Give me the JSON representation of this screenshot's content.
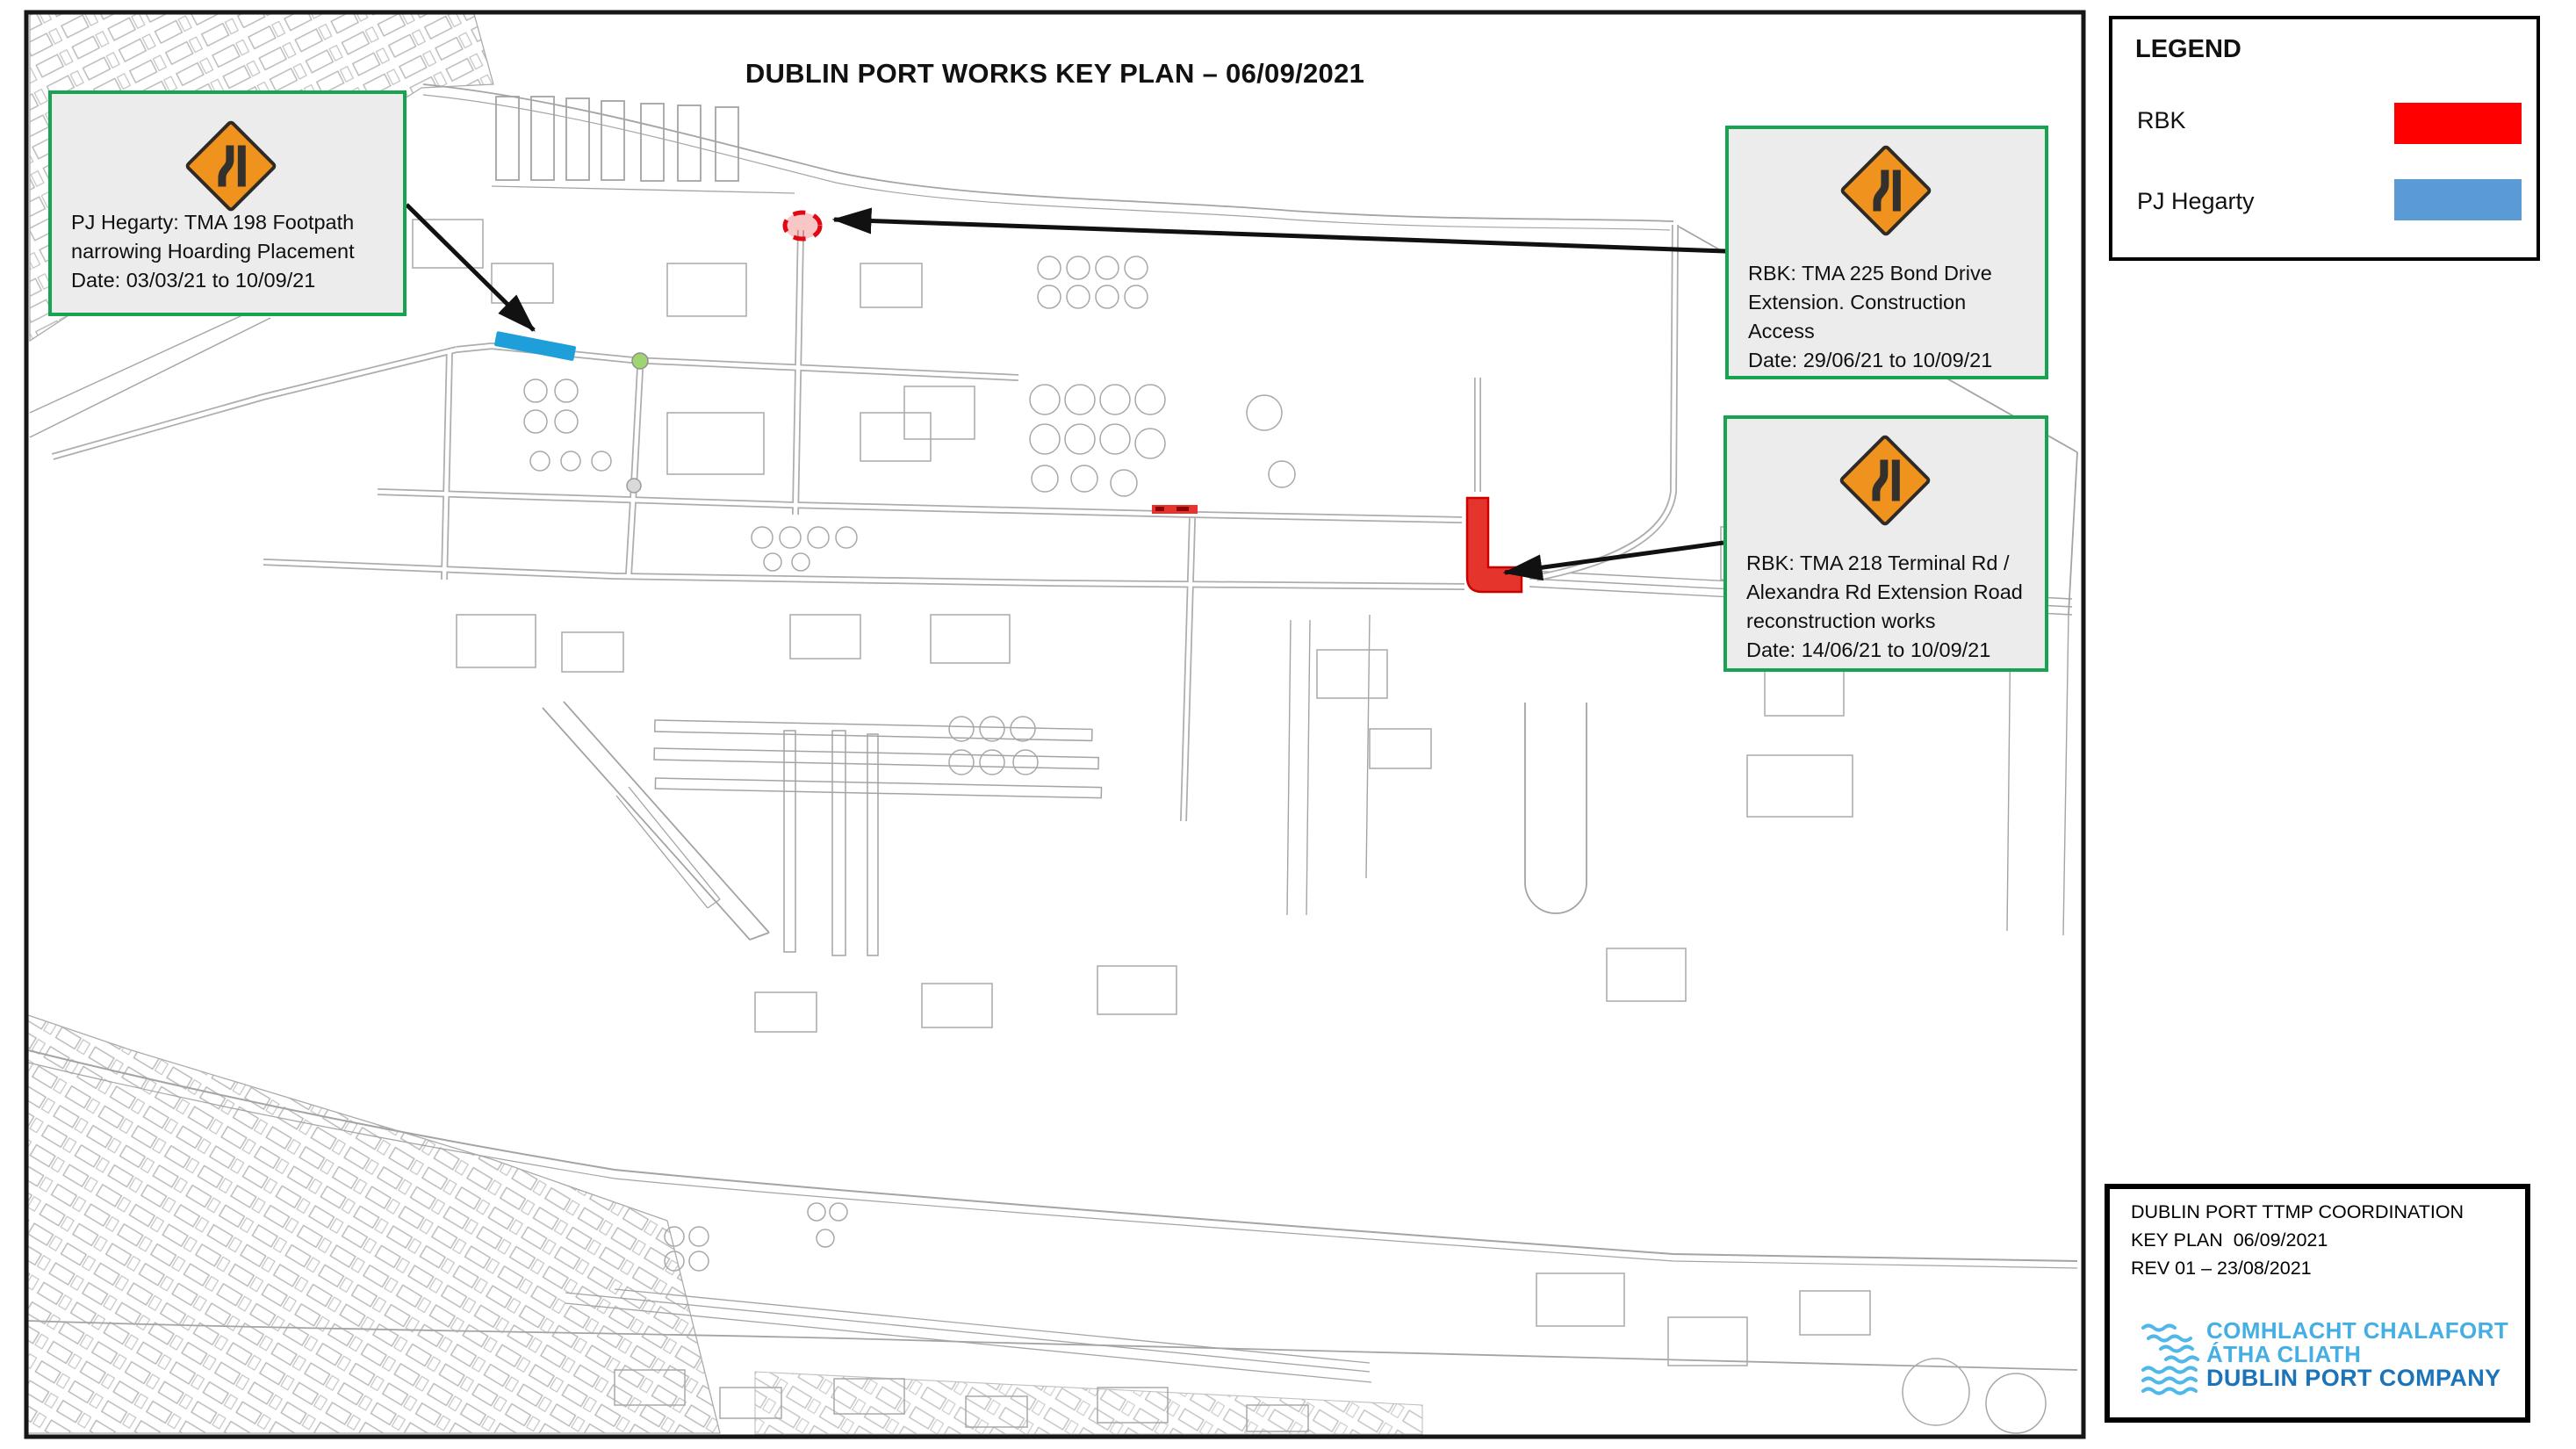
{
  "title": "DUBLIN PORT WORKS KEY PLAN – 06/09/2021",
  "callouts": [
    {
      "id": "tma-198",
      "text": "PJ Hegarty: TMA 198 Footpath\nnarrowing Hoarding Placement\nDate: 03/03/21 to 10/09/21"
    },
    {
      "id": "tma-225",
      "text": "RBK: TMA 225 Bond Drive\nExtension. Construction\nAccess\nDate: 29/06/21 to 10/09/21"
    },
    {
      "id": "tma-218",
      "text": "RBK: TMA 218 Terminal Rd /\nAlexandra Rd Extension Road\nreconstruction works\nDate: 14/06/21 to 10/09/21"
    }
  ],
  "legend": {
    "title": "LEGEND",
    "entries": [
      {
        "label": "RBK",
        "color": "#FE0000"
      },
      {
        "label": "PJ Hegarty",
        "color": "#5B9BD5"
      }
    ]
  },
  "title_block": {
    "line1": "DUBLIN PORT TTMP COORDINATION",
    "line2": "KEY PLAN  06/09/2021",
    "line3": "REV 01 – 23/08/2021",
    "logo": {
      "line1": "COMHLACHT CHALAFORT",
      "line2": "ÁTHA CLIATH",
      "line3": "DUBLIN PORT COMPANY",
      "light_blue": "#45AEE3",
      "dark_blue": "#1B74B9"
    }
  },
  "markers": {
    "pj_hegarty_footpath_zone": {
      "color": "#1E9FD9"
    },
    "bond_drive_extension_zone": {
      "color": "#E30613"
    },
    "terminal_rd_works_zone": {
      "color": "#E5342C"
    },
    "tolka_quay_rd_segment": {
      "color": "#E5342C"
    }
  },
  "sign": {
    "meaning": "road-narrows-warning"
  }
}
